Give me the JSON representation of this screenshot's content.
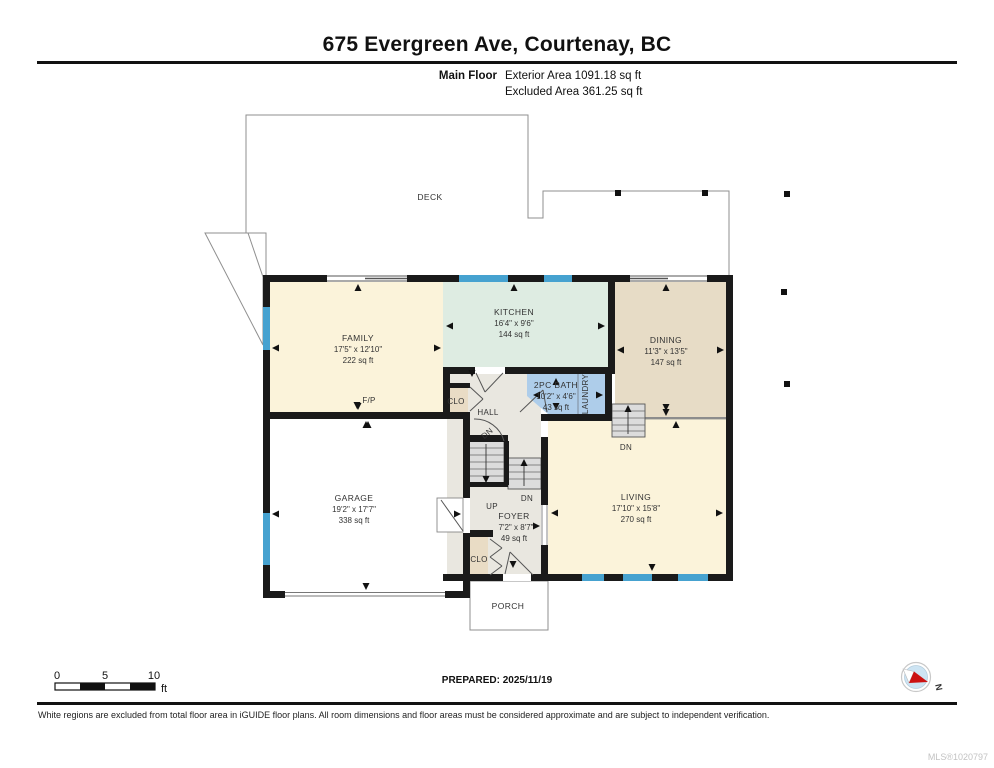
{
  "header": {
    "title": "675 Evergreen Ave, Courtenay, BC",
    "floor_label": "Main Floor",
    "exterior_area": "Exterior Area 1091.18 sq ft",
    "excluded_area": "Excluded Area 361.25 sq ft"
  },
  "plan": {
    "deck_label": "DECK",
    "porch_label": "PORCH",
    "rooms": {
      "family": {
        "name": "FAMILY",
        "dims": "17'5\" x 12'10\"",
        "area": "222 sq ft"
      },
      "kitchen": {
        "name": "KITCHEN",
        "dims": "16'4\" x 9'6\"",
        "area": "144 sq ft"
      },
      "dining": {
        "name": "DINING",
        "dims": "11'3\" x 13'5\"",
        "area": "147 sq ft"
      },
      "bath": {
        "name": "2PC BATH",
        "dims": "10'2\" x 4'6\"",
        "area": "43 sq ft"
      },
      "living": {
        "name": "LIVING",
        "dims": "17'10\" x 15'8\"",
        "area": "270 sq ft"
      },
      "garage": {
        "name": "GARAGE",
        "dims": "19'2\" x 17'7\"",
        "area": "338 sq ft"
      },
      "foyer": {
        "name": "FOYER",
        "dims": "7'2\" x 8'7\"",
        "area": "49 sq ft"
      }
    },
    "labels": {
      "hall": "HALL",
      "laundry": "LAUNDRY",
      "closet_hall": "CLO",
      "closet_foyer": "CLO",
      "fireplace": "F/P",
      "dn_basement": "DN",
      "dn_foyer": "DN",
      "dn_living": "DN",
      "up": "UP"
    }
  },
  "scale_bar": {
    "tick_0": "0",
    "tick_5": "5",
    "tick_10": "10",
    "unit": "ft"
  },
  "prepared_label": "PREPARED: 2025/11/19",
  "compass_label": "N",
  "footer": {
    "disclaimer": "White regions are excluded from total floor area in iGUIDE floor plans. All room dimensions and floor areas must be considered approximate and are subject to independent verification.",
    "mls": "MLS®1020797"
  },
  "colors": {
    "wall": "#1a1a1a",
    "window_blue": "#46a2d0",
    "family_living_fill": "#fbf3da",
    "kitchen_fill": "#deece2",
    "dining_fill": "#e7dcc6",
    "bath_fill": "#aecdea",
    "hall_foyer_fill": "#e9e7e0",
    "closet_fill": "#e9dcc5",
    "stairs_fill": "#dcdcdc"
  }
}
